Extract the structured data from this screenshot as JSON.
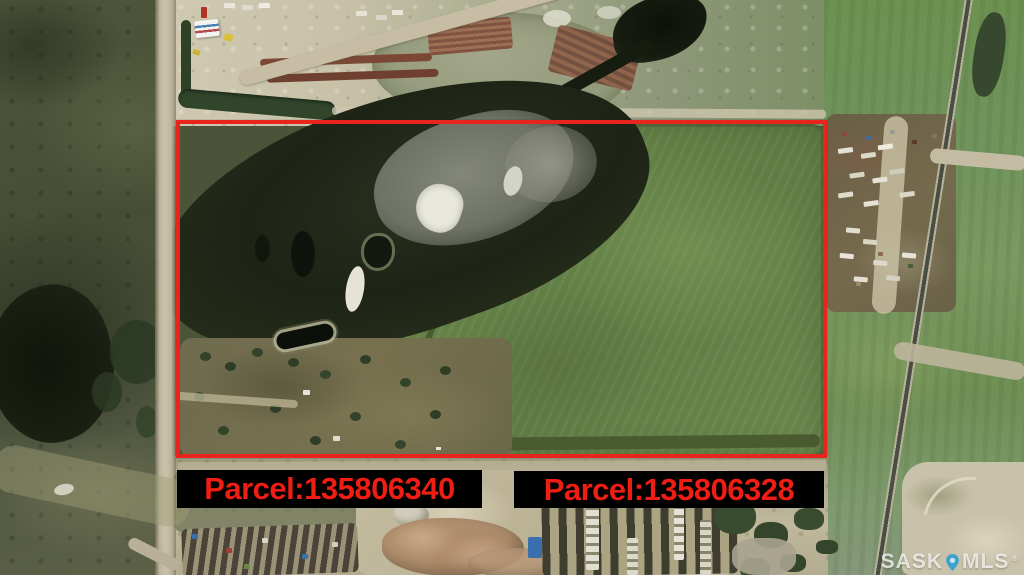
{
  "parcels": [
    {
      "id_label": "Parcel:135806340"
    },
    {
      "id_label": "Parcel:135806328"
    }
  ],
  "watermark": {
    "prefix": "SASK",
    "suffix": "MLS",
    "registered_mark": "®"
  },
  "colors": {
    "boundary_red": "#e8251c",
    "parcel_text_red": "#ef1d13",
    "label_background": "#000000",
    "watermark_text": "#f8f8f6",
    "watermark_pin_blue": "#2f9fd0"
  }
}
